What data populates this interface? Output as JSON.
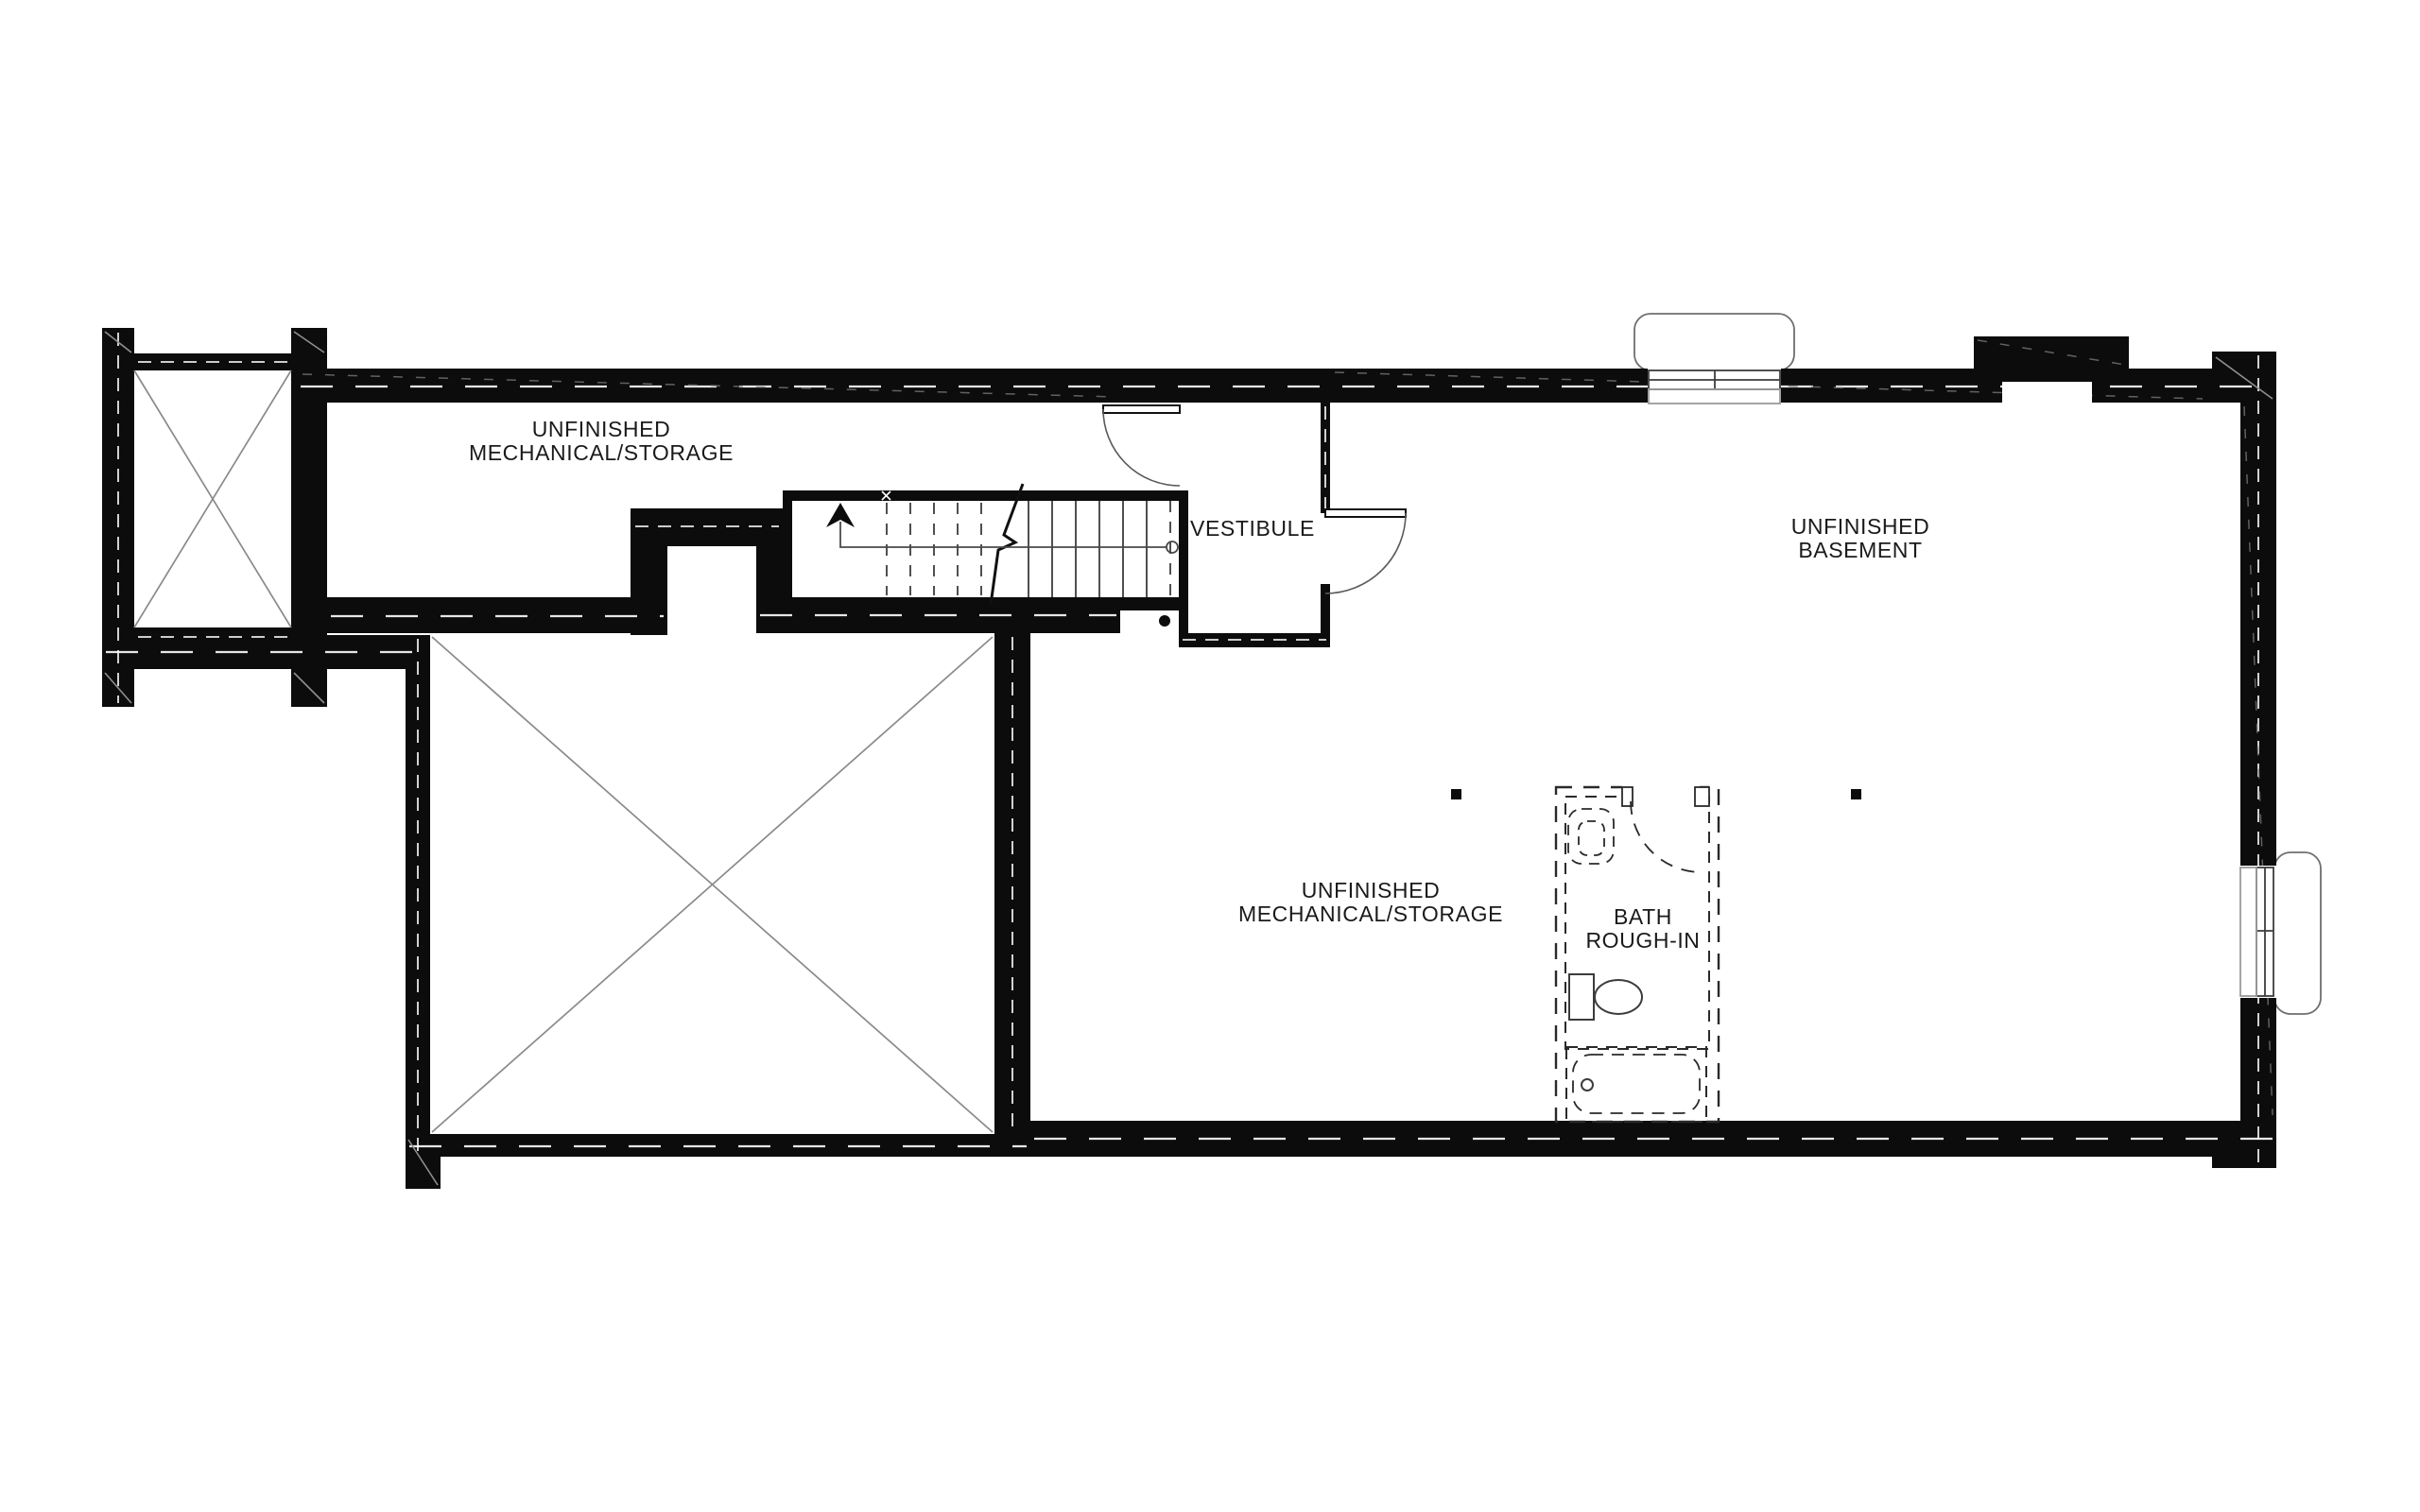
{
  "document": {
    "type": "architectural floor plan",
    "floor": "basement"
  },
  "colors": {
    "wall": "#0c0c0c",
    "line": "#3c3c3c",
    "hatch": "#8f8f8f",
    "text": "#1a1a1a",
    "background": "#ffffff"
  },
  "labels": {
    "mech_storage_upper": {
      "line1": "UNFINISHED",
      "line2": "MECHANICAL/STORAGE"
    },
    "vestibule": {
      "line1": "VESTIBULE"
    },
    "basement": {
      "line1": "UNFINISHED",
      "line2": "BASEMENT"
    },
    "mech_storage_lower": {
      "line1": "UNFINISHED",
      "line2": "MECHANICAL/STORAGE"
    },
    "bath": {
      "line1": "BATH",
      "line2": "ROUGH-IN"
    }
  }
}
